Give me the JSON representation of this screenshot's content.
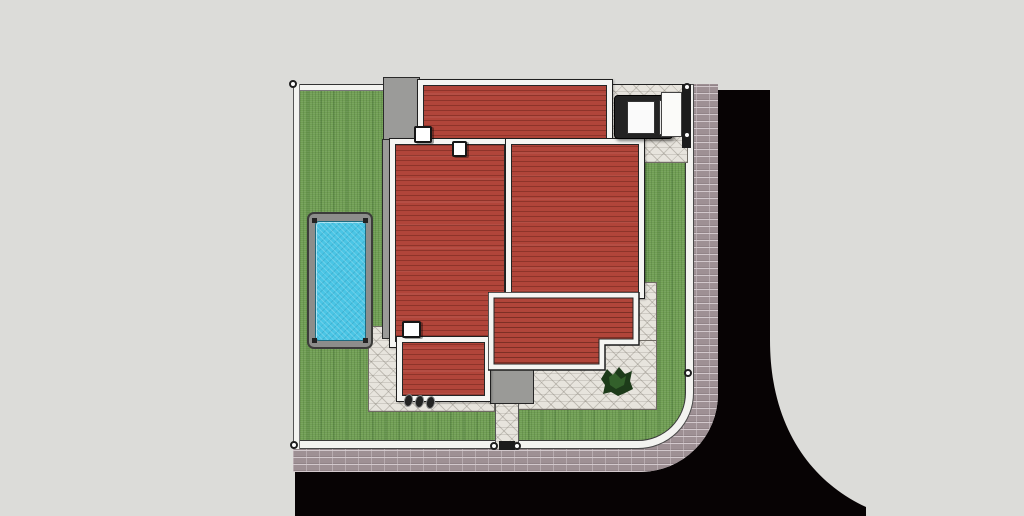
{
  "scene": {
    "type": "top-down architectural site plan 3D render",
    "elements": [
      "property lot with lawn and white perimeter fence",
      "swimming pool with gray deck",
      "house with five red hipped roof sections and white fascia",
      "two roof chimneys",
      "gray concrete terrace and entry porch",
      "flagstone walkways around house",
      "carport with parked car",
      "driveway gate on right fence",
      "pedestrian gate on bottom fence with stone walkway",
      "corner shrub at house notch",
      "three small bins at lower-left of house",
      "brick paver sidewalk along right and bottom streets",
      "black asphalt street wrapping a rounded corner"
    ]
  },
  "palette": {
    "background": "#dcdcd9",
    "road": "#070304",
    "sidewalk_brick": "#9e9094",
    "fence": "#f3f3f0",
    "grass": "#6b9b50",
    "flagstone": "#e7e4dd",
    "concrete": "#9b9b99",
    "porch_concrete": "#9a9a97",
    "roof_red": "#b1453a",
    "roof_frame": "#f5f5f2",
    "pool_deck": "#8d8d8b",
    "pool_water": "#4ac5e5",
    "plant": "#1d3b1a",
    "plant_light": "#3a6a30",
    "car_body": "#232323",
    "car_roof": "#fafafa",
    "car_glass": "#e8e8e8",
    "gate": "#1c1c1c",
    "chimney": "#ffffff",
    "gate_door": "#fbfbf9"
  }
}
